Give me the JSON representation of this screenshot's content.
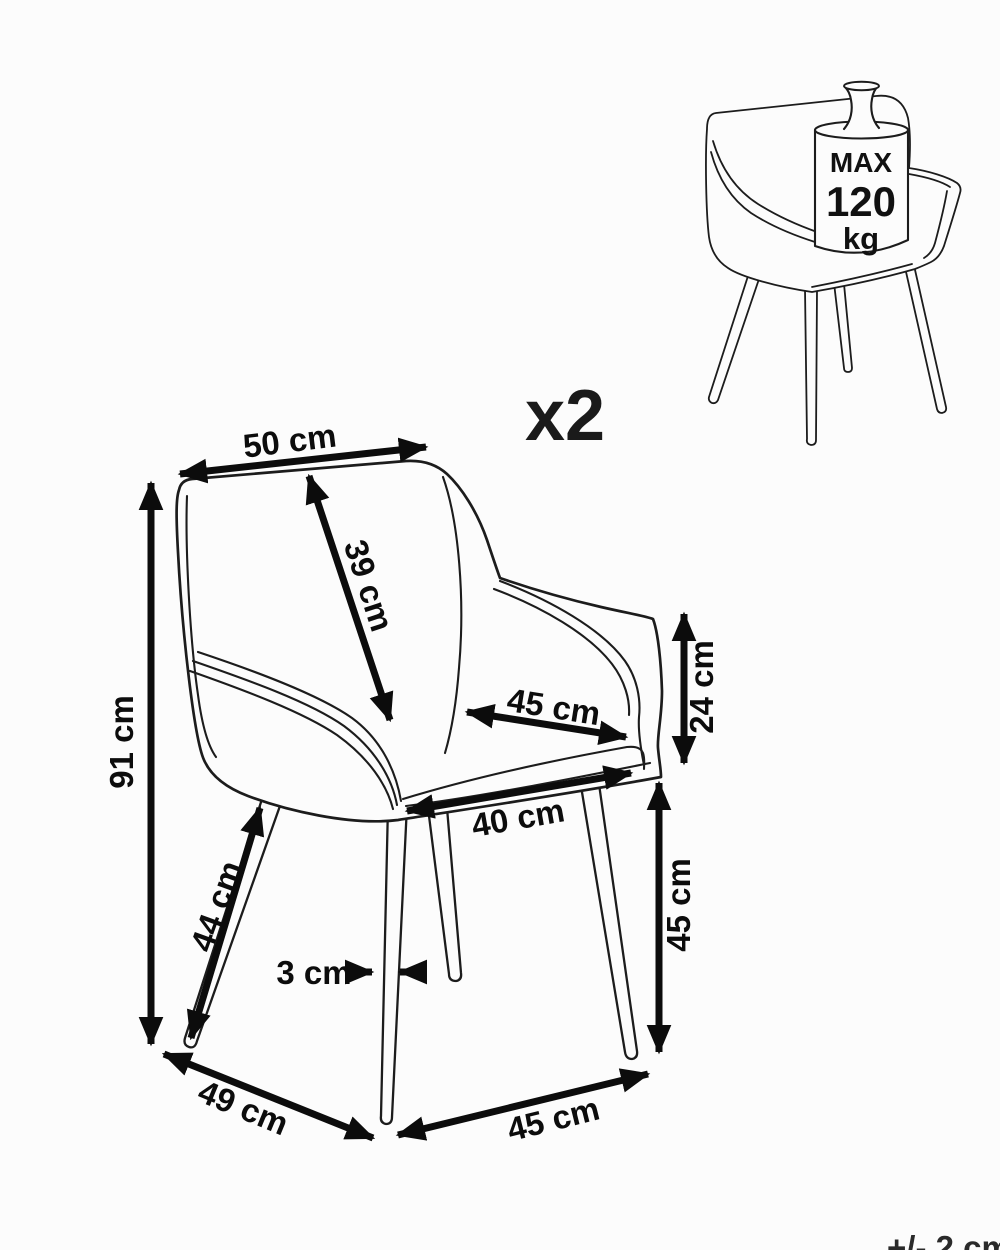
{
  "canvas": {
    "bg": "#fcfcfc",
    "ink": "#1c1c1c",
    "arrow": "#0c0c0c"
  },
  "quantity": {
    "label": "x2"
  },
  "tolerance": {
    "label": "+/- 2 cm"
  },
  "capacity_badge": {
    "line1": "MAX",
    "line2": "120",
    "line3": "kg"
  },
  "dims": {
    "back_width": "50 cm",
    "backrest_height": "39 cm",
    "total_height": "91 cm",
    "seat_depth": "45 cm",
    "armrest_drop": "24 cm",
    "seat_front_width": "40 cm",
    "front_leg_length": "44 cm",
    "leg_thickness": "3 cm",
    "seat_height": "45 cm",
    "base_depth": "49 cm",
    "base_width": "45 cm"
  }
}
